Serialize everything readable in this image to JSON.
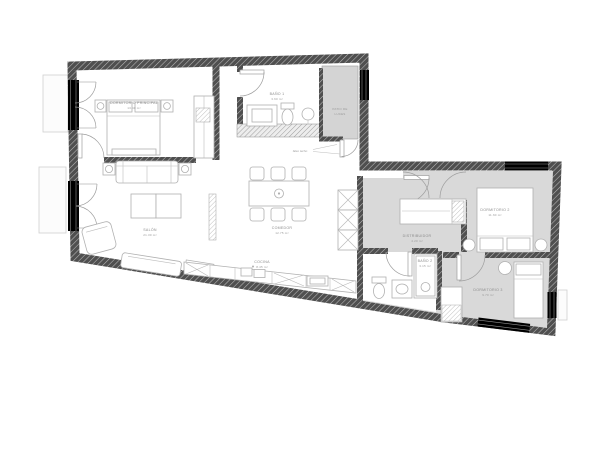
{
  "rooms": {
    "master": {
      "label": "DORMITORIO PRINCIPAL",
      "area": "13.40 m²"
    },
    "bath1": {
      "label": "BAÑO 1",
      "area": "3.60 m²"
    },
    "living": {
      "label": "SALÓN",
      "area": "21.30 m²"
    },
    "dining": {
      "label": "COMEDOR",
      "area": "12.75 m²"
    },
    "kitchen": {
      "label": "COCINA",
      "area": "8.45 m²"
    },
    "hall": {
      "label": "DISTRIBUIDOR",
      "area": "4.20 m²"
    },
    "bedroom2": {
      "label": "DORMITORIO 2",
      "area": "11.60 m²"
    },
    "bath2": {
      "label": "BAÑO 2",
      "area": "3.15 m²"
    },
    "bedroom3": {
      "label": "DORMITORIO 3",
      "area": "9.70 m²"
    },
    "shaft": {
      "label": "PATIO DE",
      "label2": "LUCES"
    }
  },
  "annotations": {
    "ceiling_note": "falso techo"
  },
  "colors": {
    "wall": "#4f4f4f",
    "wall_hatch_line": "#bababa",
    "floor_gray": "#d9d9d9",
    "shaft_gray": "#d4d4d4",
    "furniture_stroke": "#b0b0b0",
    "label_text": "#8c8c8c",
    "background": "#ffffff"
  }
}
